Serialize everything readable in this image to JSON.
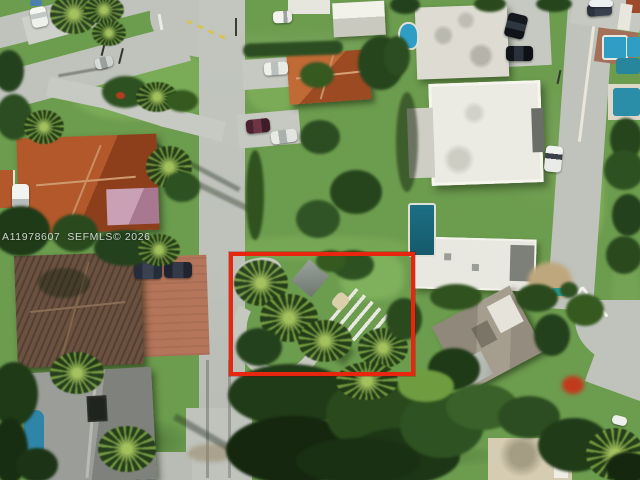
{
  "image": {
    "kind": "aerial-drone-real-estate-photo",
    "watermark": "A11978607  SEFMLS© 2026",
    "highlight_box_color": "#e8250f"
  },
  "colors": {
    "road": "#bfc3bc",
    "grass": "#6c9c4e",
    "terracotta_roof": "#b2582a",
    "brown_roof": "#6b5140",
    "gray_roof": "#9a9d98",
    "white_roof": "#ecebe3",
    "pool_blue": "#2f9dc4",
    "pool_teal": "#2a8ea8",
    "highlight_red": "#e8250f"
  }
}
